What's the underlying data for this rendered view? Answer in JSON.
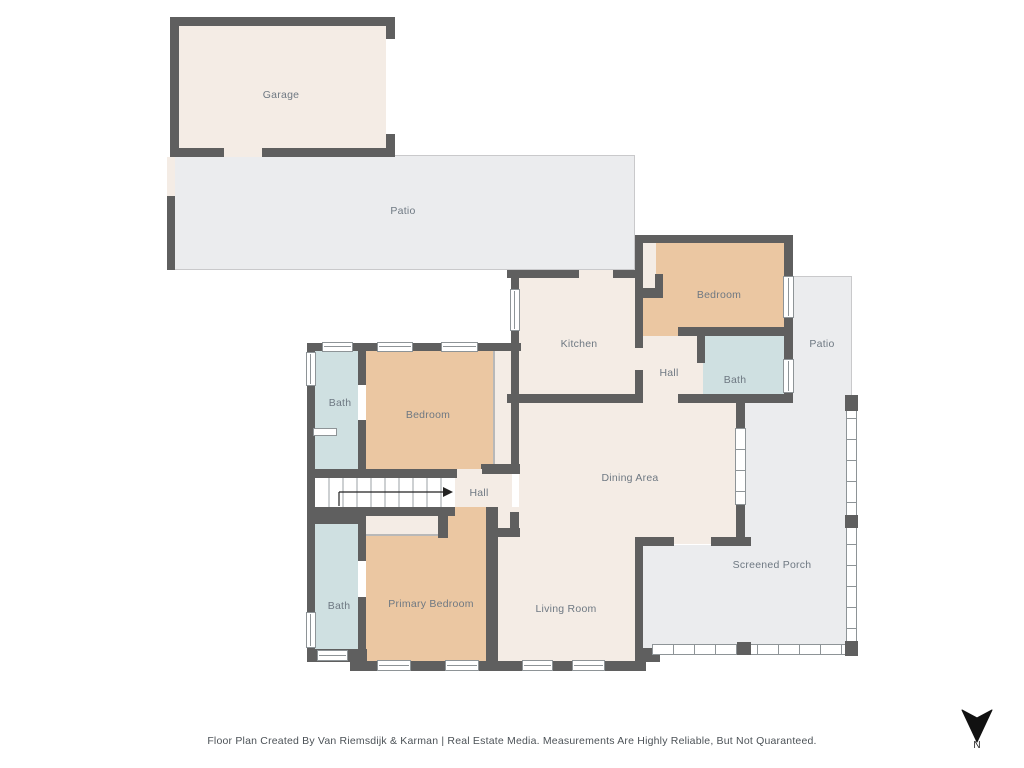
{
  "title": "Residential Floor Plan",
  "rooms": [
    {
      "id": "garage",
      "label": "Garage"
    },
    {
      "id": "patio-top",
      "label": "Patio"
    },
    {
      "id": "kitchen",
      "label": "Kitchen"
    },
    {
      "id": "bedroom-top-right",
      "label": "Bedroom"
    },
    {
      "id": "hall-top-right",
      "label": "Hall"
    },
    {
      "id": "bath-top-right",
      "label": "Bath"
    },
    {
      "id": "patio-right",
      "label": "Patio"
    },
    {
      "id": "dining-area",
      "label": "Dining Area"
    },
    {
      "id": "screened-porch",
      "label": "Screened Porch"
    },
    {
      "id": "bath-mid-left",
      "label": "Bath"
    },
    {
      "id": "bedroom-mid-left",
      "label": "Bedroom"
    },
    {
      "id": "hall-center",
      "label": "Hall"
    },
    {
      "id": "bath-bottom-left",
      "label": "Bath"
    },
    {
      "id": "primary-bedroom",
      "label": "Primary Bedroom"
    },
    {
      "id": "living-room",
      "label": "Living Room"
    }
  ],
  "compass": {
    "label": "N",
    "direction": "arrow-points-down"
  },
  "footer": {
    "text": "Floor Plan Created By Van Riemsdijk & Karman | Real Estate Media. Measurements Are Highly Reliable, But Not Quaranteed."
  },
  "colors": {
    "wall": "#5f5f5f",
    "room_cream": "#f4ece5",
    "bedroom_tan": "#ebc7a2",
    "bath_blue": "#cfe0e1",
    "outdoor_gray": "#ebecee",
    "label_text": "#6e7882",
    "footer_text": "#4c5257",
    "compass": "#111111"
  }
}
